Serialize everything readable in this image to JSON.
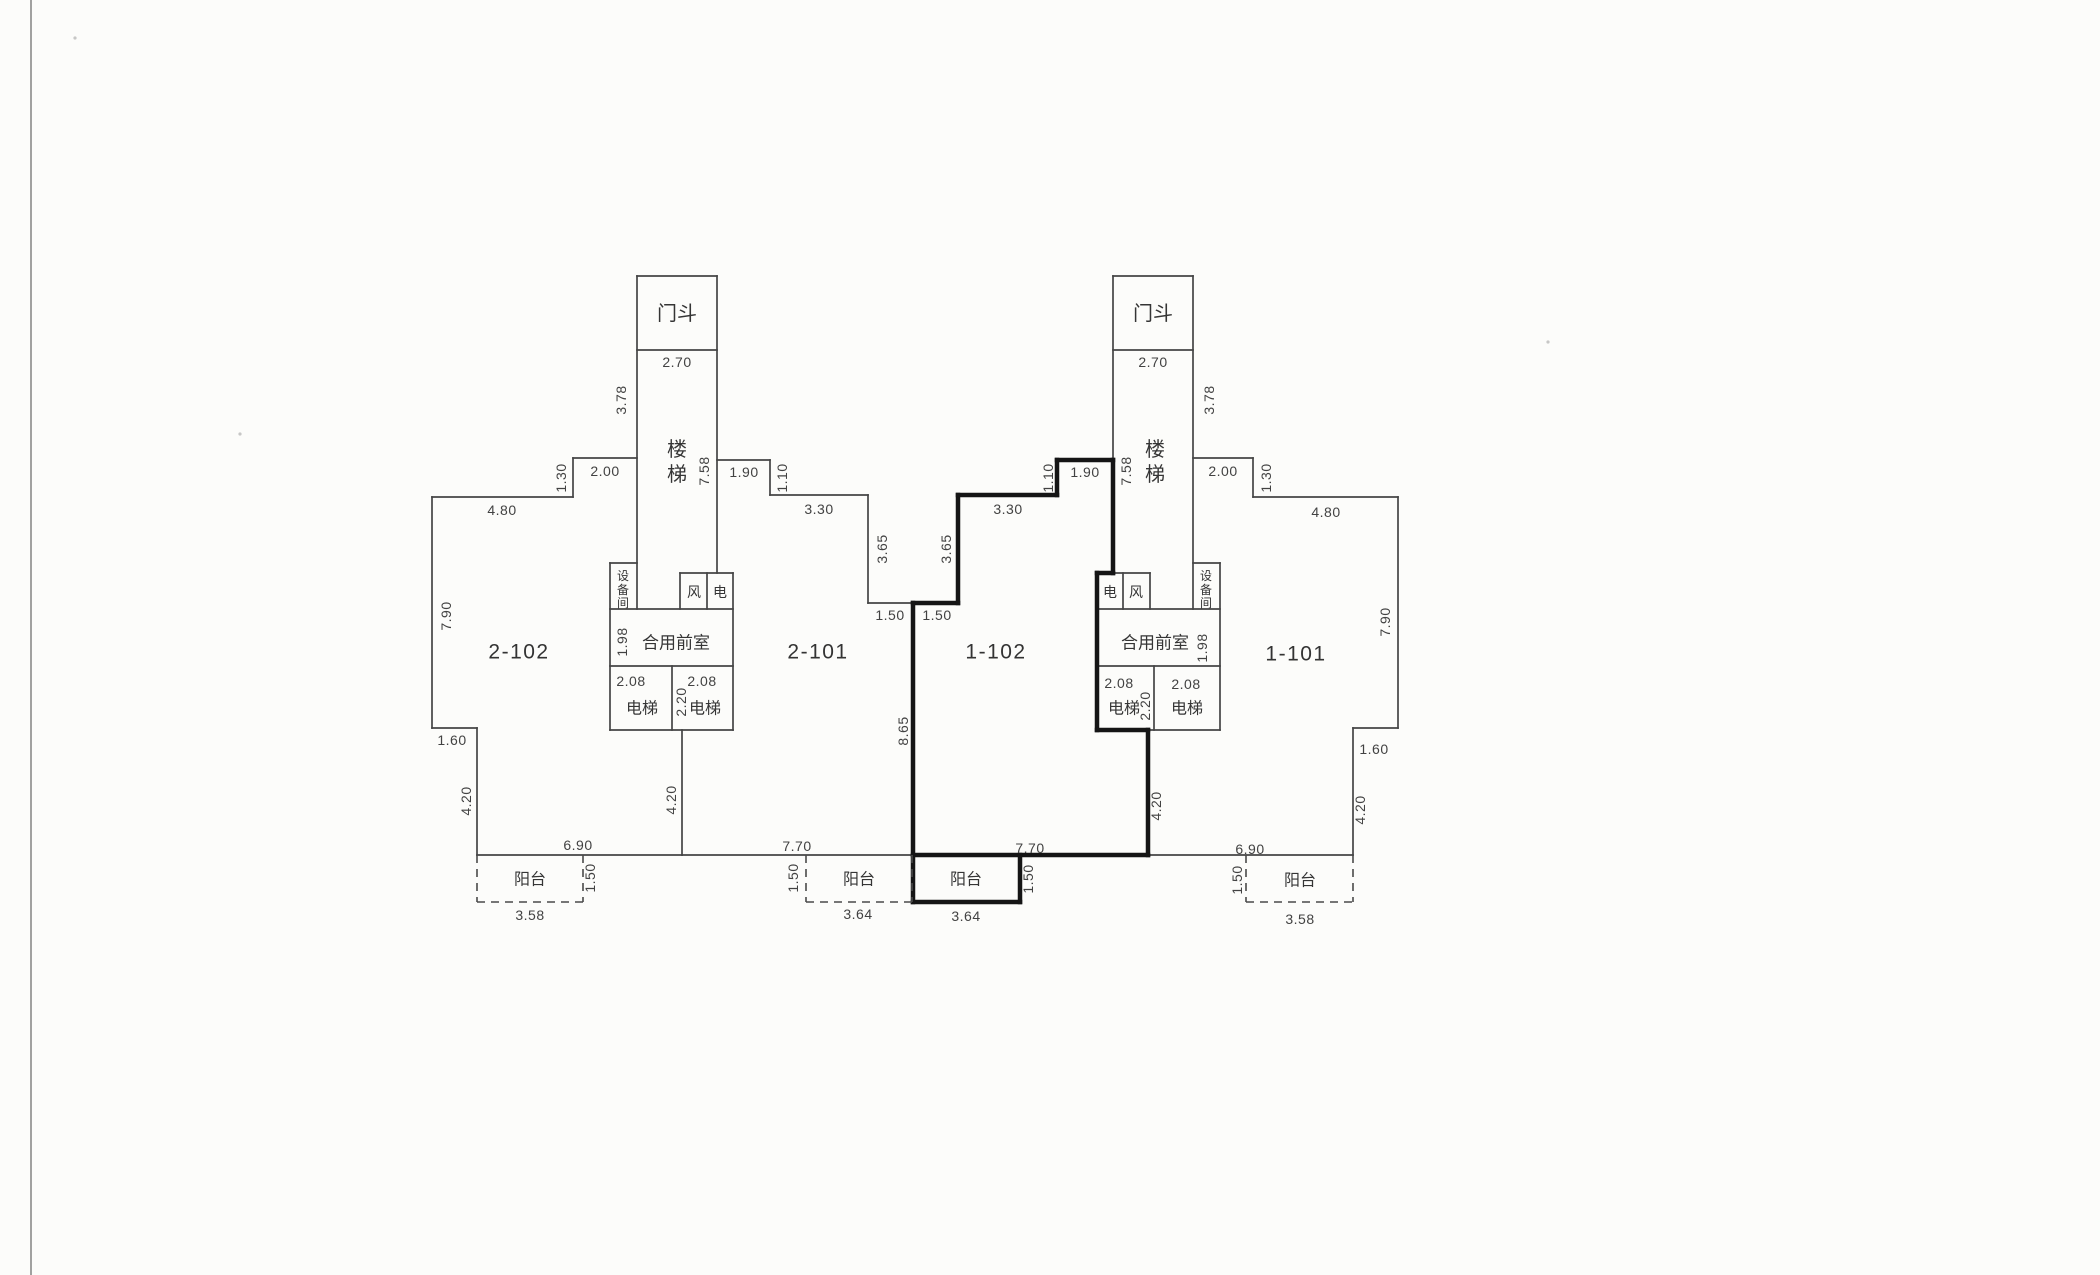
{
  "document": {
    "type": "scanned architectural floor plan",
    "paper_color": "#fcfcfa",
    "ink_color": "#454545",
    "bold_ink_color": "#151515"
  },
  "plan": {
    "unit_numbers": [
      "2-102",
      "2-101",
      "1-102",
      "1-101"
    ],
    "room_names": {
      "door_vestibule": "门斗",
      "stairs": "楼梯",
      "equipment_room": "设备间",
      "vent_shaft": "风",
      "electric_shaft": "电",
      "shared_front_room": "合用前室",
      "elevator": "电梯",
      "balcony": "阳台"
    },
    "dimensions_m": {
      "door_vestibule_width": "2.70",
      "stair_upper": "3.78",
      "stair_total": "7.58",
      "top_step": [
        "2.00",
        "1.30",
        "1.90",
        "1.10",
        "3.30",
        "3.65",
        "1.50"
      ],
      "end_unit_top": "4.80",
      "end_unit_side": "7.90",
      "end_step": "1.60",
      "lower_side": "4.20",
      "center_side": "8.65",
      "front_room_depth": "1.98",
      "elevator_width": "2.08",
      "elevator_depth": "2.20",
      "bottom_end": "6.90",
      "bottom_center": "7.70",
      "balcony_depth": "1.50",
      "balcony_end_width": "3.58",
      "balcony_center_width": "3.64"
    },
    "walls_thin": [
      [
        432,
        497,
        573,
        497
      ],
      [
        573,
        458,
        573,
        497
      ],
      [
        573,
        458,
        637,
        458
      ],
      [
        432,
        497,
        432,
        728
      ],
      [
        432,
        728,
        477,
        728
      ],
      [
        477,
        728,
        477,
        855
      ],
      [
        477,
        855,
        682,
        855
      ],
      [
        682,
        730,
        682,
        855
      ],
      [
        682,
        855,
        913,
        855
      ],
      [
        637,
        276,
        717,
        276
      ],
      [
        637,
        276,
        637,
        609
      ],
      [
        717,
        276,
        717,
        573
      ],
      [
        637,
        350,
        717,
        350
      ],
      [
        610,
        563,
        637,
        563
      ],
      [
        610,
        563,
        610,
        730
      ],
      [
        680,
        573,
        733,
        573
      ],
      [
        680,
        573,
        680,
        609
      ],
      [
        707,
        573,
        707,
        609
      ],
      [
        733,
        573,
        733,
        730
      ],
      [
        610,
        609,
        733,
        609
      ],
      [
        610,
        666,
        733,
        666
      ],
      [
        610,
        730,
        733,
        730
      ],
      [
        672,
        666,
        672,
        730
      ],
      [
        717,
        460,
        770,
        460
      ],
      [
        770,
        460,
        770,
        495
      ],
      [
        770,
        495,
        868,
        495
      ],
      [
        868,
        495,
        868,
        603
      ],
      [
        868,
        603,
        913,
        603
      ],
      [
        1113,
        276,
        1193,
        276
      ],
      [
        1193,
        276,
        1193,
        609
      ],
      [
        1113,
        276,
        1113,
        460
      ],
      [
        1113,
        350,
        1193,
        350
      ],
      [
        1193,
        563,
        1220,
        563
      ],
      [
        1220,
        563,
        1220,
        730
      ],
      [
        1113,
        573,
        1150,
        573
      ],
      [
        1123,
        573,
        1123,
        609
      ],
      [
        1150,
        573,
        1150,
        609
      ],
      [
        1097,
        609,
        1220,
        609
      ],
      [
        1097,
        666,
        1220,
        666
      ],
      [
        1148,
        730,
        1220,
        730
      ],
      [
        1154,
        666,
        1154,
        730
      ],
      [
        1193,
        458,
        1253,
        458
      ],
      [
        1253,
        458,
        1253,
        497
      ],
      [
        1253,
        497,
        1398,
        497
      ],
      [
        1398,
        497,
        1398,
        728
      ],
      [
        1353,
        728,
        1398,
        728
      ],
      [
        1353,
        728,
        1353,
        855
      ],
      [
        1148,
        855,
        1353,
        855
      ]
    ],
    "walls_bold": [
      [
        913,
        603,
        958,
        603
      ],
      [
        958,
        495,
        958,
        603
      ],
      [
        958,
        495,
        1057,
        495
      ],
      [
        1057,
        460,
        1057,
        495
      ],
      [
        1057,
        460,
        1113,
        460
      ],
      [
        1113,
        460,
        1113,
        573
      ],
      [
        1097,
        573,
        1113,
        573
      ],
      [
        1097,
        573,
        1097,
        730
      ],
      [
        1097,
        730,
        1148,
        730
      ],
      [
        1148,
        730,
        1148,
        855
      ],
      [
        913,
        855,
        1148,
        855
      ],
      [
        913,
        603,
        913,
        902
      ],
      [
        913,
        902,
        1020,
        902
      ],
      [
        1020,
        855,
        1020,
        902
      ]
    ],
    "walls_dashed": [
      [
        477,
        855,
        477,
        902
      ],
      [
        477,
        902,
        583,
        902
      ],
      [
        583,
        855,
        583,
        902
      ],
      [
        806,
        855,
        806,
        902
      ],
      [
        806,
        902,
        912,
        902
      ],
      [
        912,
        855,
        912,
        902
      ],
      [
        1246,
        855,
        1246,
        902
      ],
      [
        1246,
        902,
        1353,
        902
      ],
      [
        1353,
        855,
        1353,
        902
      ]
    ],
    "labels": [
      {
        "t": "2-102",
        "x": 519,
        "y": 652,
        "r": 0,
        "s": 21,
        "k": "unit"
      },
      {
        "t": "2-101",
        "x": 818,
        "y": 652,
        "r": 0,
        "s": 21,
        "k": "unit"
      },
      {
        "t": "1-102",
        "x": 996,
        "y": 652,
        "r": 0,
        "s": 21,
        "k": "unit"
      },
      {
        "t": "1-101",
        "x": 1296,
        "y": 654,
        "r": 0,
        "s": 21,
        "k": "unit"
      },
      {
        "t": "门斗",
        "x": 677,
        "y": 314,
        "r": 0,
        "s": 20,
        "k": "room"
      },
      {
        "t": "门斗",
        "x": 1153,
        "y": 314,
        "r": 0,
        "s": 20,
        "k": "room"
      },
      {
        "t": "楼",
        "x": 677,
        "y": 450,
        "r": 0,
        "s": 20,
        "k": "room"
      },
      {
        "t": "梯",
        "x": 677,
        "y": 475,
        "r": 0,
        "s": 20,
        "k": "room"
      },
      {
        "t": "楼",
        "x": 1155,
        "y": 450,
        "r": 0,
        "s": 20,
        "k": "room"
      },
      {
        "t": "梯",
        "x": 1155,
        "y": 475,
        "r": 0,
        "s": 20,
        "k": "room"
      },
      {
        "t": "设",
        "x": 623,
        "y": 576,
        "r": 0,
        "s": 12,
        "k": "room"
      },
      {
        "t": "备",
        "x": 623,
        "y": 590,
        "r": 0,
        "s": 12,
        "k": "room"
      },
      {
        "t": "间",
        "x": 623,
        "y": 603,
        "r": 0,
        "s": 12,
        "k": "room"
      },
      {
        "t": "设",
        "x": 1206,
        "y": 576,
        "r": 0,
        "s": 12,
        "k": "room"
      },
      {
        "t": "备",
        "x": 1206,
        "y": 590,
        "r": 0,
        "s": 12,
        "k": "room"
      },
      {
        "t": "间",
        "x": 1206,
        "y": 603,
        "r": 0,
        "s": 12,
        "k": "room"
      },
      {
        "t": "风",
        "x": 694,
        "y": 592,
        "r": 0,
        "s": 14,
        "k": "room"
      },
      {
        "t": "电",
        "x": 720,
        "y": 592,
        "r": 0,
        "s": 14,
        "k": "room"
      },
      {
        "t": "电",
        "x": 1110,
        "y": 592,
        "r": 0,
        "s": 14,
        "k": "room"
      },
      {
        "t": "风",
        "x": 1136,
        "y": 592,
        "r": 0,
        "s": 14,
        "k": "room"
      },
      {
        "t": "合用前室",
        "x": 676,
        "y": 643,
        "r": 0,
        "s": 17,
        "k": "room"
      },
      {
        "t": "合用前室",
        "x": 1155,
        "y": 643,
        "r": 0,
        "s": 17,
        "k": "room"
      },
      {
        "t": "电梯",
        "x": 642,
        "y": 709,
        "r": 0,
        "s": 16,
        "k": "room"
      },
      {
        "t": "电梯",
        "x": 705,
        "y": 709,
        "r": 0,
        "s": 16,
        "k": "room"
      },
      {
        "t": "电梯",
        "x": 1124,
        "y": 709,
        "r": 0,
        "s": 16,
        "k": "room"
      },
      {
        "t": "电梯",
        "x": 1187,
        "y": 709,
        "r": 0,
        "s": 16,
        "k": "room"
      },
      {
        "t": "阳台",
        "x": 530,
        "y": 880,
        "r": 0,
        "s": 16,
        "k": "room"
      },
      {
        "t": "阳台",
        "x": 859,
        "y": 880,
        "r": 0,
        "s": 16,
        "k": "room"
      },
      {
        "t": "阳台",
        "x": 966,
        "y": 880,
        "r": 0,
        "s": 16,
        "k": "room"
      },
      {
        "t": "阳台",
        "x": 1300,
        "y": 881,
        "r": 0,
        "s": 16,
        "k": "room"
      },
      {
        "t": "2.70",
        "x": 677,
        "y": 362,
        "r": 0,
        "s": 14,
        "k": "dim"
      },
      {
        "t": "2.70",
        "x": 1153,
        "y": 362,
        "r": 0,
        "s": 14,
        "k": "dim"
      },
      {
        "t": "3.78",
        "x": 621,
        "y": 400,
        "r": -90,
        "s": 14,
        "k": "dim"
      },
      {
        "t": "3.78",
        "x": 1209,
        "y": 400,
        "r": -90,
        "s": 14,
        "k": "dim"
      },
      {
        "t": "7.58",
        "x": 704,
        "y": 471,
        "r": -90,
        "s": 14,
        "k": "dim"
      },
      {
        "t": "7.58",
        "x": 1126,
        "y": 471,
        "r": -90,
        "s": 14,
        "k": "dim"
      },
      {
        "t": "2.00",
        "x": 605,
        "y": 471,
        "r": 0,
        "s": 14,
        "k": "dim"
      },
      {
        "t": "2.00",
        "x": 1223,
        "y": 471,
        "r": 0,
        "s": 14,
        "k": "dim"
      },
      {
        "t": "1.30",
        "x": 561,
        "y": 478,
        "r": -90,
        "s": 14,
        "k": "dim"
      },
      {
        "t": "1.30",
        "x": 1266,
        "y": 478,
        "r": -90,
        "s": 14,
        "k": "dim"
      },
      {
        "t": "4.80",
        "x": 502,
        "y": 510,
        "r": 0,
        "s": 14,
        "k": "dim"
      },
      {
        "t": "4.80",
        "x": 1326,
        "y": 512,
        "r": 0,
        "s": 14,
        "k": "dim"
      },
      {
        "t": "1.90",
        "x": 744,
        "y": 472,
        "r": 0,
        "s": 14,
        "k": "dim"
      },
      {
        "t": "1.90",
        "x": 1085,
        "y": 472,
        "r": 0,
        "s": 14,
        "k": "dim"
      },
      {
        "t": "1.10",
        "x": 782,
        "y": 478,
        "r": -90,
        "s": 14,
        "k": "dim"
      },
      {
        "t": "1.10",
        "x": 1048,
        "y": 478,
        "r": -90,
        "s": 14,
        "k": "dim"
      },
      {
        "t": "3.30",
        "x": 819,
        "y": 509,
        "r": 0,
        "s": 14,
        "k": "dim"
      },
      {
        "t": "3.30",
        "x": 1008,
        "y": 509,
        "r": 0,
        "s": 14,
        "k": "dim"
      },
      {
        "t": "3.65",
        "x": 882,
        "y": 549,
        "r": -90,
        "s": 14,
        "k": "dim"
      },
      {
        "t": "3.65",
        "x": 946,
        "y": 549,
        "r": -90,
        "s": 14,
        "k": "dim"
      },
      {
        "t": "1.50",
        "x": 890,
        "y": 615,
        "r": 0,
        "s": 14,
        "k": "dim"
      },
      {
        "t": "1.50",
        "x": 937,
        "y": 615,
        "r": 0,
        "s": 14,
        "k": "dim"
      },
      {
        "t": "7.90",
        "x": 446,
        "y": 616,
        "r": -90,
        "s": 14,
        "k": "dim"
      },
      {
        "t": "7.90",
        "x": 1385,
        "y": 622,
        "r": -90,
        "s": 14,
        "k": "dim"
      },
      {
        "t": "1.98",
        "x": 622,
        "y": 642,
        "r": -90,
        "s": 14,
        "k": "dim"
      },
      {
        "t": "1.98",
        "x": 1202,
        "y": 648,
        "r": -90,
        "s": 14,
        "k": "dim"
      },
      {
        "t": "2.08",
        "x": 631,
        "y": 681,
        "r": 0,
        "s": 14,
        "k": "dim"
      },
      {
        "t": "2.08",
        "x": 702,
        "y": 681,
        "r": 0,
        "s": 14,
        "k": "dim"
      },
      {
        "t": "2.08",
        "x": 1119,
        "y": 683,
        "r": 0,
        "s": 14,
        "k": "dim"
      },
      {
        "t": "2.08",
        "x": 1186,
        "y": 684,
        "r": 0,
        "s": 14,
        "k": "dim"
      },
      {
        "t": "2.20",
        "x": 681,
        "y": 702,
        "r": -90,
        "s": 14,
        "k": "dim"
      },
      {
        "t": "2.20",
        "x": 1145,
        "y": 706,
        "r": -90,
        "s": 14,
        "k": "dim"
      },
      {
        "t": "8.65",
        "x": 903,
        "y": 731,
        "r": -90,
        "s": 14,
        "k": "dim"
      },
      {
        "t": "4.20",
        "x": 466,
        "y": 801,
        "r": -90,
        "s": 14,
        "k": "dim"
      },
      {
        "t": "4.20",
        "x": 671,
        "y": 800,
        "r": -90,
        "s": 14,
        "k": "dim"
      },
      {
        "t": "4.20",
        "x": 1156,
        "y": 806,
        "r": -90,
        "s": 14,
        "k": "dim"
      },
      {
        "t": "4.20",
        "x": 1360,
        "y": 810,
        "r": -90,
        "s": 14,
        "k": "dim"
      },
      {
        "t": "1.60",
        "x": 452,
        "y": 740,
        "r": 0,
        "s": 14,
        "k": "dim"
      },
      {
        "t": "1.60",
        "x": 1374,
        "y": 749,
        "r": 0,
        "s": 14,
        "k": "dim"
      },
      {
        "t": "6.90",
        "x": 578,
        "y": 845,
        "r": 0,
        "s": 14,
        "k": "dim"
      },
      {
        "t": "6.90",
        "x": 1250,
        "y": 849,
        "r": 0,
        "s": 14,
        "k": "dim"
      },
      {
        "t": "7.70",
        "x": 797,
        "y": 846,
        "r": 0,
        "s": 14,
        "k": "dim"
      },
      {
        "t": "7.70",
        "x": 1030,
        "y": 848,
        "r": 0,
        "s": 14,
        "k": "dim"
      },
      {
        "t": "1.50",
        "x": 590,
        "y": 878,
        "r": -90,
        "s": 14,
        "k": "dim"
      },
      {
        "t": "1.50",
        "x": 793,
        "y": 878,
        "r": -90,
        "s": 14,
        "k": "dim"
      },
      {
        "t": "1.50",
        "x": 1028,
        "y": 879,
        "r": -90,
        "s": 14,
        "k": "dim"
      },
      {
        "t": "1.50",
        "x": 1237,
        "y": 880,
        "r": -90,
        "s": 14,
        "k": "dim"
      },
      {
        "t": "3.58",
        "x": 530,
        "y": 915,
        "r": 0,
        "s": 14,
        "k": "dim"
      },
      {
        "t": "3.58",
        "x": 1300,
        "y": 919,
        "r": 0,
        "s": 14,
        "k": "dim"
      },
      {
        "t": "3.64",
        "x": 858,
        "y": 914,
        "r": 0,
        "s": 14,
        "k": "dim"
      },
      {
        "t": "3.64",
        "x": 966,
        "y": 916,
        "r": 0,
        "s": 14,
        "k": "dim"
      }
    ],
    "scan_artifacts": {
      "edge_line_x": 31,
      "specks": [
        [
          75,
          38
        ],
        [
          240,
          434
        ],
        [
          1548,
          342
        ]
      ]
    }
  }
}
